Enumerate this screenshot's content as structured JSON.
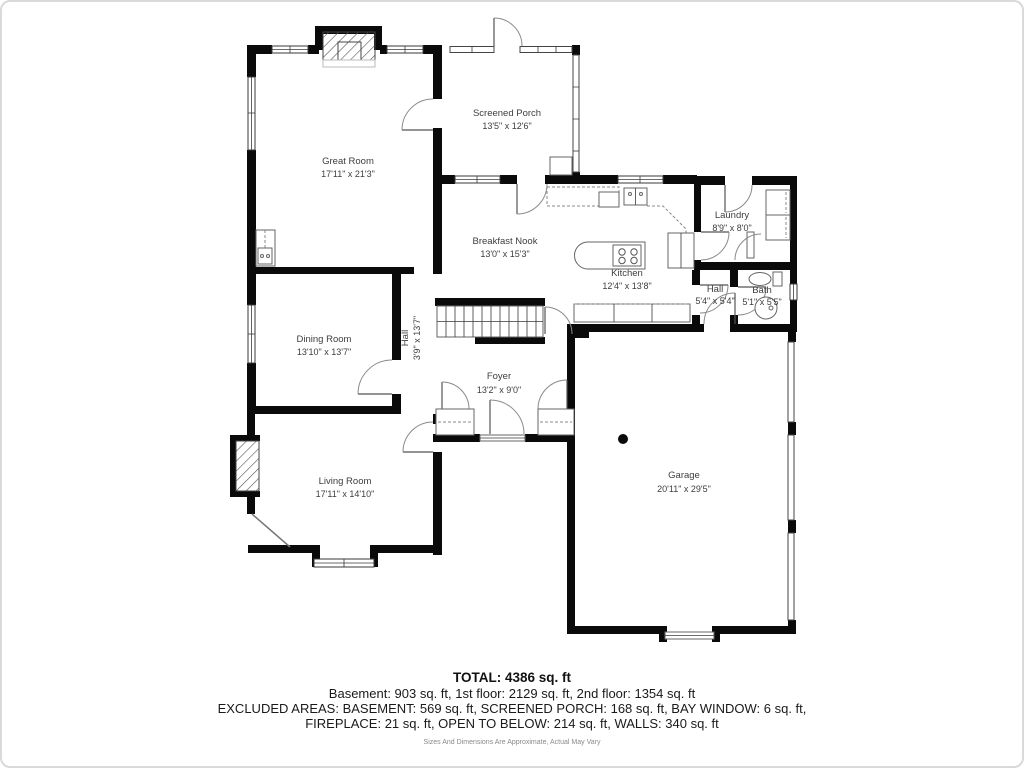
{
  "plan": {
    "rooms": {
      "great_room": {
        "name": "Great Room",
        "dims": "17'11\" x 21'3\""
      },
      "screened_porch": {
        "name": "Screened Porch",
        "dims": "13'5\" x 12'6\""
      },
      "breakfast_nook": {
        "name": "Breakfast Nook",
        "dims": "13'0\" x 15'3\""
      },
      "kitchen": {
        "name": "Kitchen",
        "dims": "12'4\" x 13'8\""
      },
      "laundry": {
        "name": "Laundry",
        "dims": "8'9\" x 8'0\""
      },
      "hall_upper": {
        "name": "Hall",
        "dims": "5'4\" x 5'4\""
      },
      "bath": {
        "name": "Bath",
        "dims": "5'1\" x 5'5\""
      },
      "dining_room": {
        "name": "Dining Room",
        "dims": "13'10\" x 13'7\""
      },
      "hall_center": {
        "name": "Hall",
        "dims": "3'9\" x 13'7\""
      },
      "foyer": {
        "name": "Foyer",
        "dims": "13'2\" x 9'0\""
      },
      "living_room": {
        "name": "Living Room",
        "dims": "17'11\" x 14'10\""
      },
      "garage": {
        "name": "Garage",
        "dims": "20'11\" x 29'5\""
      }
    }
  },
  "footer": {
    "total": "TOTAL: 4386 sq. ft",
    "floors": "Basement: 903 sq. ft, 1st floor: 2129 sq. ft, 2nd floor: 1354 sq. ft",
    "excluded_1": "EXCLUDED AREAS: BASEMENT: 569 sq. ft, SCREENED PORCH: 168 sq. ft, BAY WINDOW: 6 sq. ft,",
    "excluded_2": "FIREPLACE: 21 sq. ft, OPEN TO BELOW: 214 sq. ft, WALLS: 340 sq. ft",
    "disclaimer": "Sizes And Dimensions Are Approximate, Actual May Vary"
  },
  "colors": {
    "wall": "#0a0a0a",
    "fixture_line": "#666666",
    "label_text": "#3d3d3d",
    "card_border": "#d9d9d9",
    "disclaimer_text": "#8a8a8a"
  }
}
